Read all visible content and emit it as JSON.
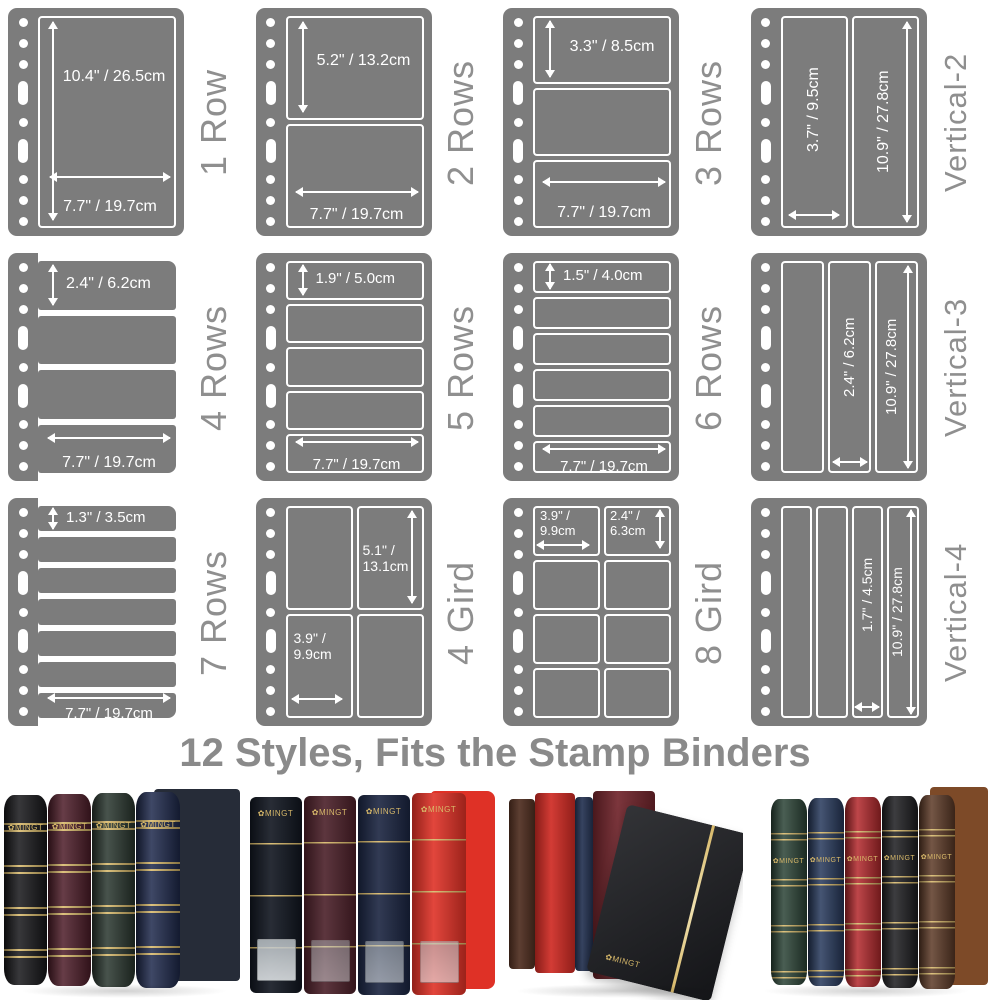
{
  "caption": "12 Styles, Fits the Stamp Binders",
  "brand_label": "✿MINGT",
  "colors": {
    "page_gray": "#7c7c7c",
    "label_gray": "#8f8f8f",
    "caption_gray": "#8a8a8a",
    "gold": "#d8b96a",
    "dim_white": "#ffffff"
  },
  "styles": [
    {
      "label": "1 Row",
      "dim_vertical": "10.4\" / 26.5cm",
      "dim_horizontal": "7.7\" / 19.7cm"
    },
    {
      "label": "2 Rows",
      "dim_vertical": "5.2\" / 13.2cm",
      "dim_horizontal": "7.7\" / 19.7cm"
    },
    {
      "label": "3 Rows",
      "dim_vertical": "3.3\" / 8.5cm",
      "dim_horizontal": "7.7\" / 19.7cm"
    },
    {
      "label": "Vertical-2",
      "dim_col_width": "3.7\" / 9.5cm",
      "dim_col_height": "10.9\" / 27.8cm"
    },
    {
      "label": "4 Rows",
      "dim_vertical": "2.4\" / 6.2cm",
      "dim_horizontal": "7.7\" / 19.7cm"
    },
    {
      "label": "5 Rows",
      "dim_vertical": "1.9\" / 5.0cm",
      "dim_horizontal": "7.7\" / 19.7cm"
    },
    {
      "label": "6 Rows",
      "dim_vertical": "1.5\" / 4.0cm",
      "dim_horizontal": "7.7\" / 19.7cm"
    },
    {
      "label": "Vertical-3",
      "dim_col_width": "2.4\" / 6.2cm",
      "dim_col_height": "10.9\" / 27.8cm"
    },
    {
      "label": "7 Rows",
      "dim_vertical": "1.3\" / 3.5cm",
      "dim_horizontal": "7.7\" / 19.7cm"
    },
    {
      "label": "4 Gird",
      "dim_cell_height": "5.1\" /\n13.1cm",
      "dim_cell_width": "3.9\" /\n9.9cm"
    },
    {
      "label": "8 Gird",
      "dim_cell_width": "3.9\" /\n9.9cm",
      "dim_cell_height": "2.4\" /\n6.3cm"
    },
    {
      "label": "Vertical-4",
      "dim_col_width": "1.7\" / 4.5cm",
      "dim_col_height": "10.9\" / 27.8cm"
    }
  ],
  "photos": {
    "p1": {
      "slipcase": "#262c38",
      "spines": [
        "#17171a",
        "#4e1d29",
        "#2a372f",
        "#1f2a4d"
      ]
    },
    "p2": {
      "slipcase": "#df3126",
      "spines": [
        "#10151f",
        "#4a1f28",
        "#1a2440",
        "#df3126"
      ]
    },
    "p3": {
      "books": [
        "#4f2e20",
        "#cf2b24",
        "#253352",
        "#71252c"
      ],
      "album": "#1b1c20"
    },
    "p4": {
      "slipcase": "#7d4a28",
      "spines": [
        "#2c4437",
        "#27395c",
        "#b3282c",
        "#1d1d20",
        "#5d3a27"
      ]
    }
  }
}
